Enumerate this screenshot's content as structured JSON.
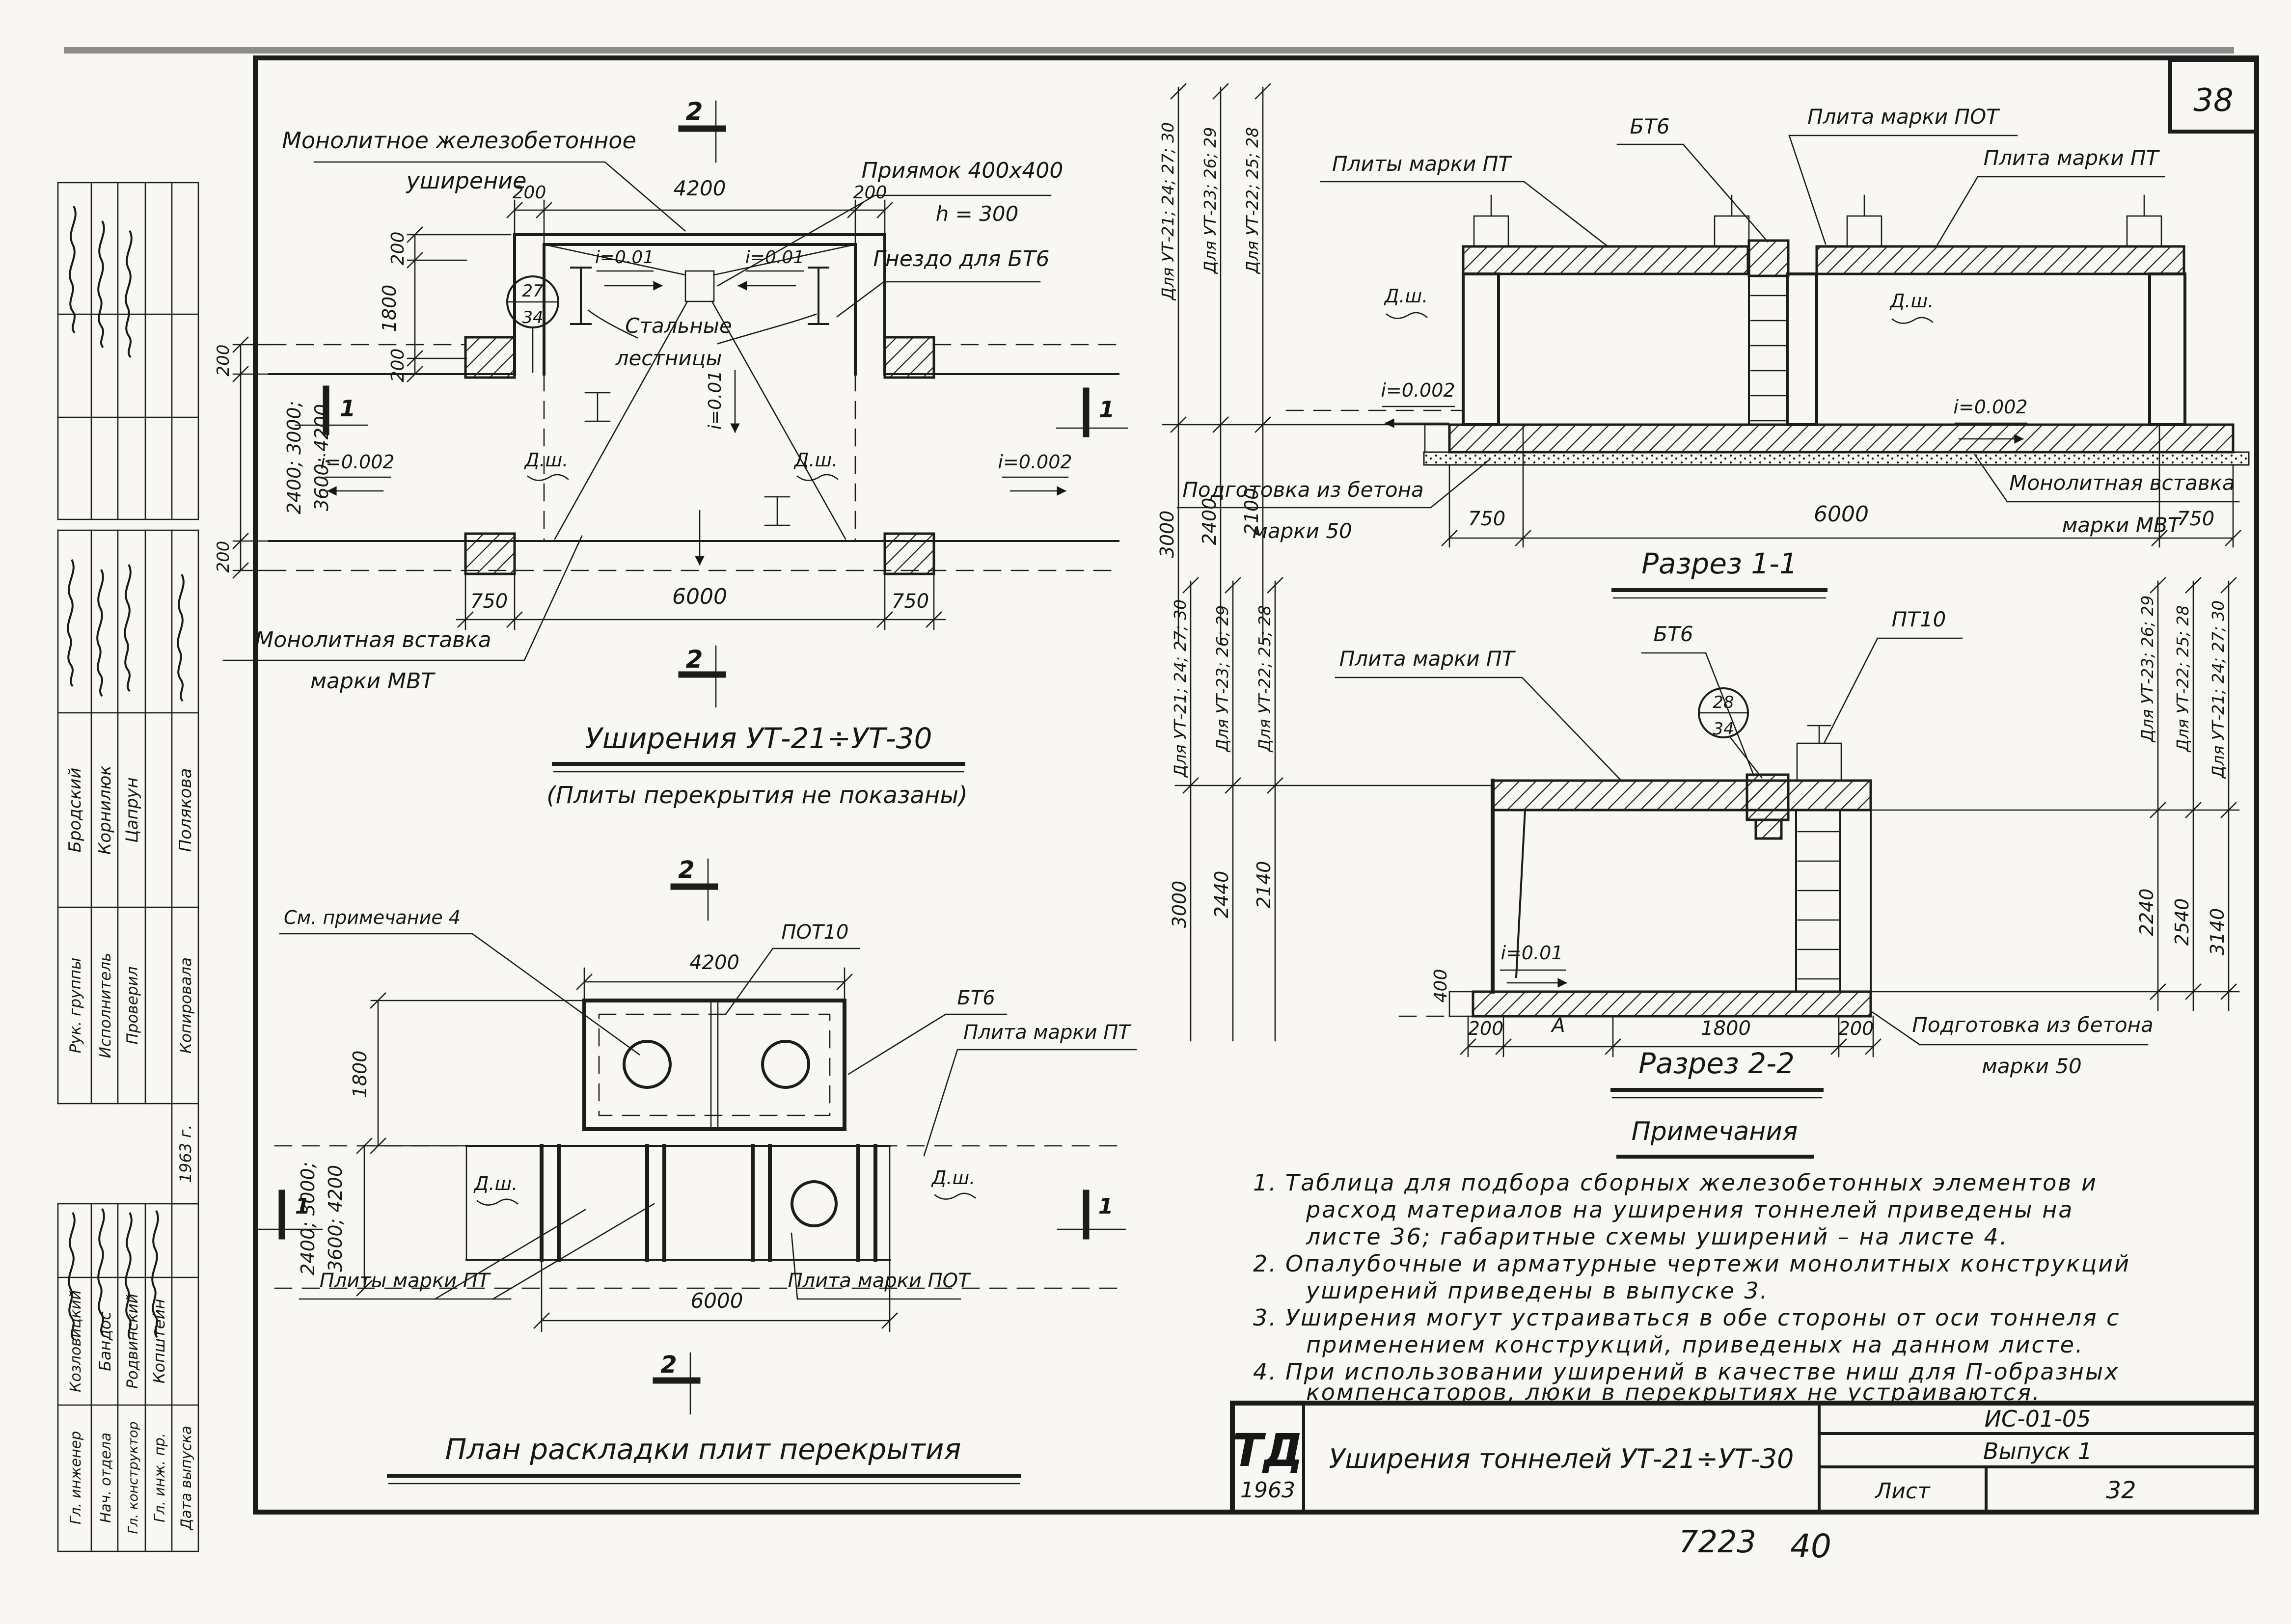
{
  "sheet": {
    "page_number": "38",
    "stamp_code": "7223",
    "stamp_number": "40"
  },
  "title_block": {
    "logo": "ТД",
    "logo_year": "1963",
    "title": "Уширения тоннелей УТ-21÷УТ-30",
    "doc_code": "ИС-01-05",
    "issue": "Выпуск 1",
    "sheet_label": "Лист",
    "sheet_number": "32"
  },
  "sidebar": {
    "staff": [
      {
        "role": "Рук. группы",
        "name": "Бродский"
      },
      {
        "role": "Исполнитель",
        "name": "Корнилюк"
      },
      {
        "role": "Проверил",
        "name": "Цапрун"
      },
      {
        "role": "",
        "name": ""
      },
      {
        "role": "Копировала",
        "name": "Полякова"
      }
    ],
    "year": "1963 г.",
    "management": [
      {
        "role": "Гл. инженер",
        "name": "Козловицкий"
      },
      {
        "role": "Нач. отдела",
        "name": "Бандос"
      },
      {
        "role": "Гл. конструктор",
        "name": "Родвинский"
      },
      {
        "role": "Гл. инж. пр.",
        "name": "Копштейн"
      },
      {
        "role": "Дата выпуска",
        "name": ""
      }
    ]
  },
  "plan_top": {
    "callout_widening_1": "Монолитное железобетонное",
    "callout_widening_2": "уширение",
    "callout_pit_1": "Приямок 400х400",
    "callout_pit_2": "h = 300",
    "callout_socket": "Гнездо для БТ6",
    "callout_ladders_1": "Стальные",
    "callout_ladders_2": "лестницы",
    "callout_insert_1": "Монолитная вставка",
    "callout_insert_2": "марки МВТ",
    "slope_i001_left": "i=0.01",
    "slope_i001_right": "i=0.01",
    "slope_i001_center": "i=0.01",
    "slope_i0002_left": "i=0.002",
    "slope_i0002_right": "i=0.002",
    "joint_left": "Д.ш.",
    "joint_right": "Д.ш.",
    "ref_top": "27",
    "ref_bottom": "34",
    "dim_200_a": "200",
    "dim_4200": "4200",
    "dim_200_b": "200",
    "dim_200_c": "200",
    "dim_1800": "1800",
    "dim_200_d": "200",
    "dim_200_e": "200",
    "dim_width_1": "2400; 3000;",
    "dim_width_2": "3600; 4200",
    "dim_200_f": "200",
    "dim_750_l": "750",
    "dim_6000": "6000",
    "dim_750_r": "750",
    "mark_2_top": "2",
    "mark_2_bot": "2",
    "mark_1_left": "1",
    "mark_1_right": "1",
    "title": "Уширения УТ-21÷УТ-30",
    "subtitle": "(Плиты перекрытия не показаны)"
  },
  "plan_bottom": {
    "callout_note": "См. примечание 4",
    "label_pot10": "ПОТ10",
    "label_bt6": "БТ6",
    "label_pt": "Плита марки ПТ",
    "label_pt_plates": "Плиты марки ПТ",
    "label_pot_plate": "Плита марки ПОТ",
    "joint_left": "Д.ш.",
    "joint_right": "Д.ш.",
    "dim_4200": "4200",
    "dim_1800": "1800",
    "dim_width_1": "2400; 3000;",
    "dim_width_2": "3600; 4200",
    "dim_6000": "6000",
    "mark_2_top": "2",
    "mark_2_bot": "2",
    "mark_1_left": "1",
    "mark_1_right": "1",
    "title": "План раскладки плит перекрытия"
  },
  "section1": {
    "title": "Разрез 1-1",
    "for_ut_a": "Для УТ-21; 24; 27; 30",
    "for_ut_b": "Для УТ-23; 26; 29",
    "for_ut_c": "Для УТ-22; 25; 28",
    "dim_h_a": "3000",
    "dim_h_b": "2400",
    "dim_h_c": "2100",
    "label_pt_plates": "Плиты марки ПТ",
    "label_bt6": "БТ6",
    "label_pot": "Плита марки ПОТ",
    "label_pt": "Плита марки ПТ",
    "joint_left": "Д.ш.",
    "joint_right": "Д.ш.",
    "slope_left": "i=0.002",
    "slope_right": "i=0.002",
    "callout_prep_1": "Подготовка из бетона",
    "callout_prep_2": "марки 50",
    "callout_insert_1": "Монолитная вставка",
    "callout_insert_2": "марки МВТ",
    "dim_750_l": "750",
    "dim_6000": "6000",
    "dim_750_r": "750"
  },
  "section2": {
    "title": "Разрез 2-2",
    "left_for_ut_a": "Для УТ-21; 24; 27; 30",
    "left_for_ut_b": "Для УТ-23; 26; 29",
    "left_for_ut_c": "Для УТ-22; 25; 28",
    "left_dim_a": "3000",
    "left_dim_b": "2440",
    "left_dim_c": "2140",
    "right_for_ut_a": "Для УТ-23; 26; 29",
    "right_for_ut_b": "Для УТ-22; 25; 28",
    "right_for_ut_c": "Для УТ-21; 24; 27; 30",
    "right_dim_a": "2240",
    "right_dim_b": "2540",
    "right_dim_c": "3140",
    "label_pt": "Плита марки ПТ",
    "label_bt6": "БТ6",
    "label_pt10": "ПТ10",
    "ref_top": "28",
    "ref_bottom": "34",
    "slope": "i=0.01",
    "callout_prep_1": "Подготовка из бетона",
    "callout_prep_2": "марки 50",
    "dim_200_a": "200",
    "dim_A": "А",
    "dim_1800": "1800",
    "dim_200_b": "200",
    "dim_400": "400"
  },
  "notes": {
    "heading": "Примечания",
    "n1": "1.",
    "i1l1": "Таблица для подбора сборных железобетонных элементов и",
    "i1l2": "расход материалов на уширения тоннелей приведены на",
    "i1l3": "листе 36; габаритные схемы уширений – на листе 4.",
    "n2": "2.",
    "i2l1": "Опалубочные и арматурные чертежи монолитных конструкций",
    "i2l2": "уширений приведены в выпуске 3.",
    "n3": "3.",
    "i3l1": "Уширения могут устраиваться в обе стороны от оси тоннеля с",
    "i3l2": "применением конструкций, приведеных на данном листе.",
    "n4": "4.",
    "i4l1": "При использовании уширений в качестве ниш для П-образных",
    "i4l2": "компенсаторов, люки в перекрытиях не устраиваются."
  }
}
